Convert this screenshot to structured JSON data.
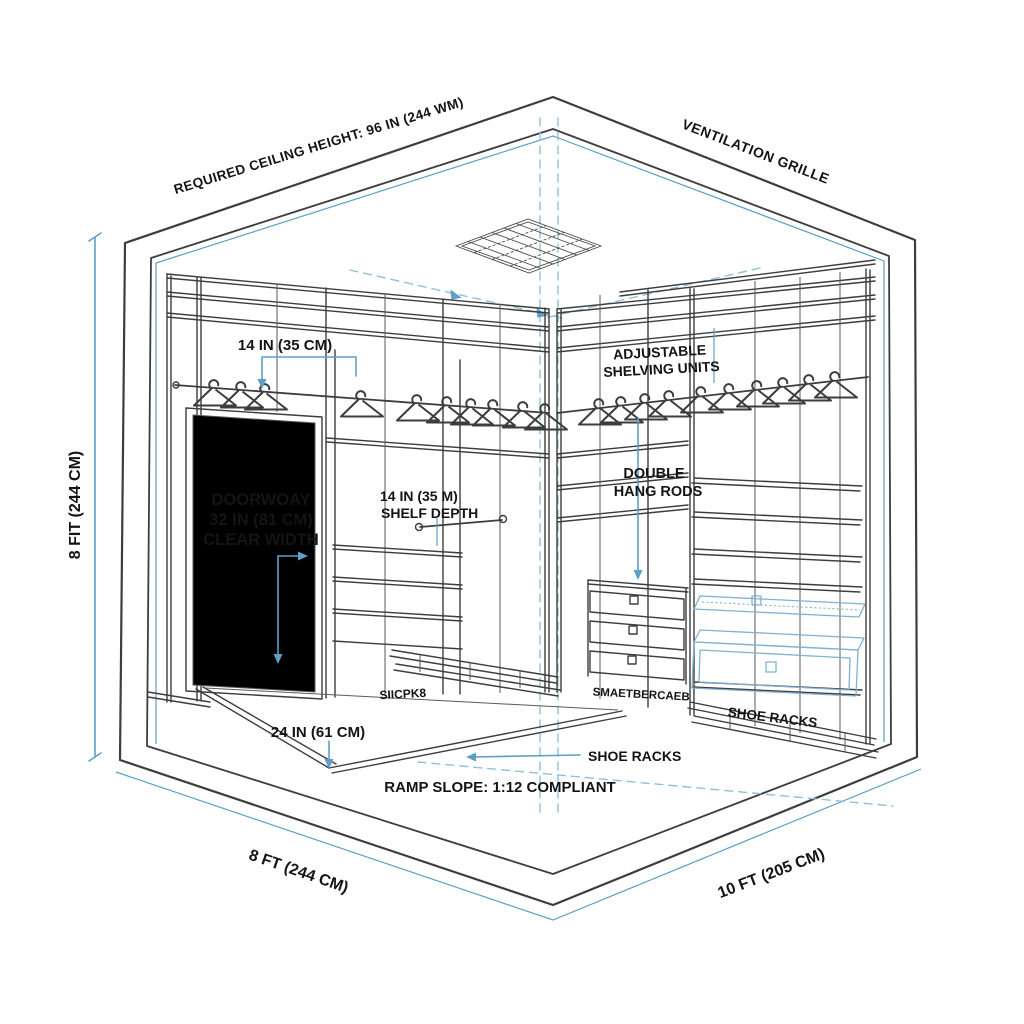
{
  "colors": {
    "background": "#ffffff",
    "line_dark": "#3d3d3d",
    "accent_blue": "#5d9fc6",
    "dashed_blue": "#8fc0dc",
    "text_color": "#141414"
  },
  "labels": {
    "ceiling_height": "REQUIRED CEILING HEIGHT: 96 IN (244 WM)",
    "ventilation": "VENTILATION GRILLE",
    "top_shelf_width": "14 IN (35 CM)",
    "adjustable_shelving": {
      "line1": "ADJUSTABLE",
      "line2": "SHELVING UNITS"
    },
    "doorway": {
      "line1": "DOORWOAY",
      "line2": "32 IN (81 CM)",
      "line3": "CLEAR WIDTH"
    },
    "shelf_depth": {
      "line1": "14 IN (35 M)",
      "line2": "SHELF DEPTH"
    },
    "double_hang": {
      "line1": "DOUBLE",
      "line2": "HANG RODS"
    },
    "ramp_width": "24 IN (61 CM)",
    "shoe_racks_center": "SHOE RACKS",
    "shoe_racks_right": "SHOE RACKS",
    "garbled_shoe_left": "SIICPK8",
    "garbled_shoe_right": "SMAETBERCAEB",
    "ramp_slope": "RAMP SLOPE: 1:12 COMPLIANT",
    "dim_height": "8 FIT (244 CM)",
    "dim_depth": "8 FT (244 CM)",
    "dim_width": "10 FT (205 CM)"
  }
}
